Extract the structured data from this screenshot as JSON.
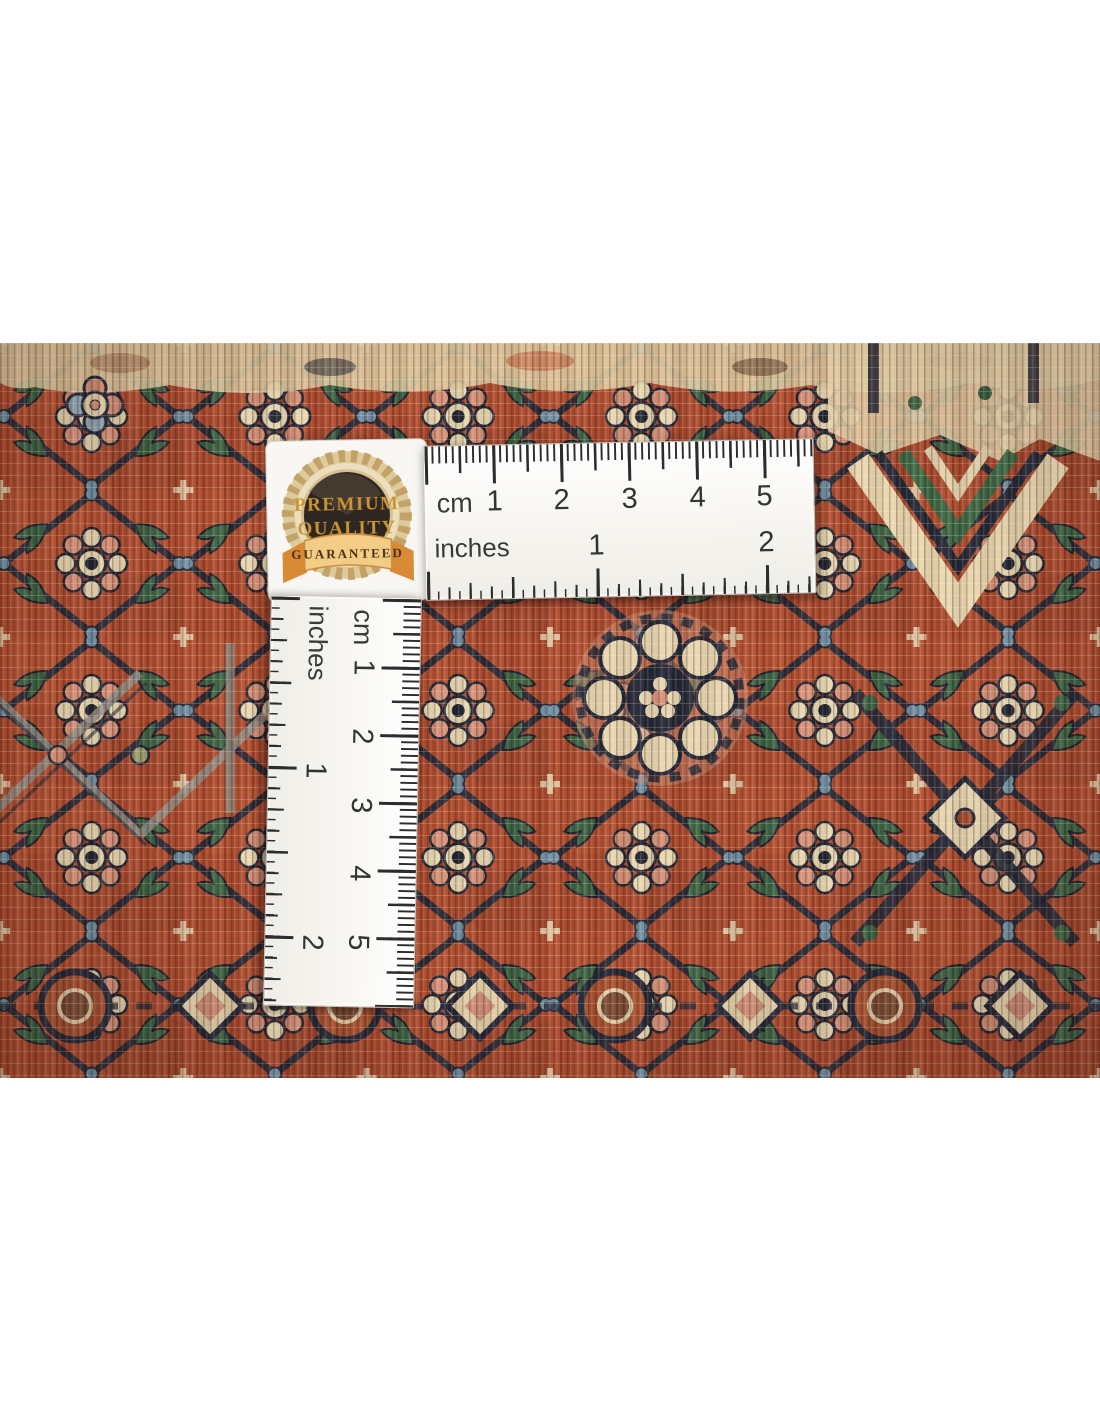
{
  "badge": {
    "line1": "PREMIUM",
    "line2": "QUALITY",
    "banner": "GUARANTEED"
  },
  "ruler_horizontal": {
    "cm_label": "cm",
    "inches_label": "inches",
    "cm_numbers": [
      "1",
      "2",
      "3",
      "4",
      "5"
    ],
    "inch_numbers": [
      "1",
      "2"
    ]
  },
  "ruler_vertical": {
    "cm_label": "cm",
    "inches_label": "inches",
    "cm_numbers": [
      "1",
      "2",
      "3",
      "4",
      "5"
    ],
    "inch_numbers": [
      "1",
      "2"
    ]
  },
  "colors": {
    "rug_field": "#ad4a2d",
    "rug_navy": "#232838",
    "rug_cream": "#e6d5af",
    "rug_green": "#3b6343",
    "rug_salmon": "#d58f76",
    "rug_steel_blue": "#6e8fa2",
    "ruler_white": "#f8f7f3",
    "ruler_tick": "#2c2c2c",
    "badge_gold": "#c89434"
  }
}
